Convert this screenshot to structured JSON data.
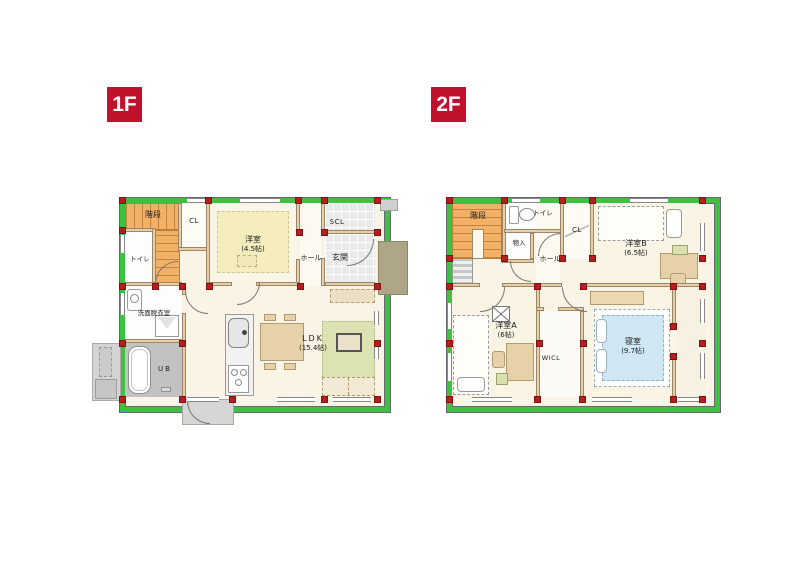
{
  "page": {
    "background": "#ffffff"
  },
  "colors": {
    "badge_red": "#c0122d",
    "wall_green": "#3ec13e",
    "pillar_red": "#b51f1f",
    "interior_wall_tan": "#e9cda4",
    "stairs_orange": "#f3b167",
    "floor_cream": "#faf4e6",
    "tatami_yellow": "#f5edbe",
    "rug_green": "#dce2b2",
    "bed_blue": "#cfe7f2",
    "bath_gray": "#c2c2c2",
    "tile_gray": "#e9e9e9",
    "porch_olive": "#ada687"
  },
  "floors": {
    "f1": {
      "badge": "1F",
      "rooms": {
        "stairs": "階段",
        "toilet": "トイレ",
        "cl": "CL",
        "yoshitsu": "洋室",
        "yoshitsu_size": "(4.5帖)",
        "hall": "ホール",
        "scl": "SCL",
        "genkan": "玄関",
        "senmen": "洗面脱衣室",
        "ub": "UB",
        "ldk": "LDK",
        "ldk_size": "(15.4帖)"
      }
    },
    "f2": {
      "badge": "2F",
      "rooms": {
        "stairs": "階段",
        "toilet": "トイレ",
        "monoire": "物入",
        "hall": "ホール",
        "cl": "CL",
        "yoshitsu_b": "洋室B",
        "yoshitsu_b_size": "(6.5帖)",
        "yoshitsu_a": "洋室A",
        "yoshitsu_a_size": "(6帖)",
        "wicl": "WICL",
        "bedroom": "寝室",
        "bedroom_size": "(9.7帖)"
      }
    }
  }
}
